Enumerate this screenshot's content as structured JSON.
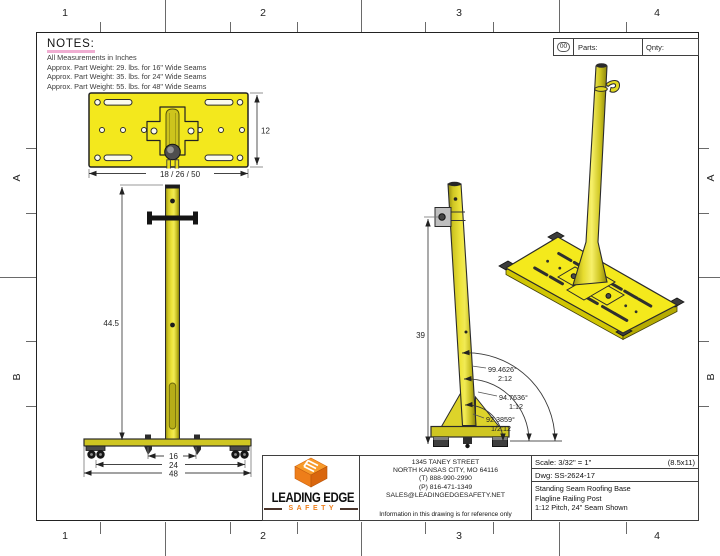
{
  "sheet": {
    "zone_columns": [
      "1",
      "2",
      "3",
      "4"
    ],
    "zone_row_a": "A",
    "zone_row_b": "B"
  },
  "notes": {
    "title": "NOTES:",
    "lines": [
      "All Measurements in Inches",
      "Approx. Part Weight: 29. lbs. for 16\" Wide Seams",
      "Approx. Part Weight: 35. lbs. for 24\" Wide Seams",
      "Approx. Part Weight: 55. lbs. for 48\" Wide Seams"
    ]
  },
  "parts_table": {
    "row_number": "00",
    "parts_label": "Parts:",
    "qty_label": "Qnty:"
  },
  "dimensions": {
    "plate_width": "18 / 26 / 50",
    "plate_depth": "12",
    "post_height_front": "44.5",
    "base_width_inner": "16",
    "base_width_mid": "24",
    "base_width_outer": "48",
    "post_height_side": "39"
  },
  "angles": [
    {
      "value": "99.4626°",
      "pitch": "2:12"
    },
    {
      "value": "94.7636°",
      "pitch": "1:12"
    },
    {
      "value": "92.3859°",
      "pitch": "1/2:12"
    }
  ],
  "title_block": {
    "scale": "Scale: 3/32\" = 1\"",
    "sheet_size": "(8.5x11)",
    "dwg": "Dwg: SS-2624-17",
    "description_lines": [
      "Standing Seam Roofing Base",
      "Flagline Railing Post",
      "1:12 Pitch, 24\" Seam Shown"
    ]
  },
  "company": {
    "logo_primary": "LEADING EDGE",
    "logo_secondary": "SAFETY",
    "address_lines": [
      "1345 TANEY STREET",
      "NORTH KANSAS CITY, MO 64116",
      "(T) 888-990-2990",
      "(P) 816-471-1349",
      "SALES@LEADINGEDGESAFETY.NET"
    ],
    "disclaimer": "Information in this drawing is for reference only"
  },
  "colors": {
    "plate_yellow": "#f3e81d",
    "post_olive": "#cfc622",
    "logo_orange": "#ef7f1c",
    "underline_pink": "#f0aed2"
  }
}
